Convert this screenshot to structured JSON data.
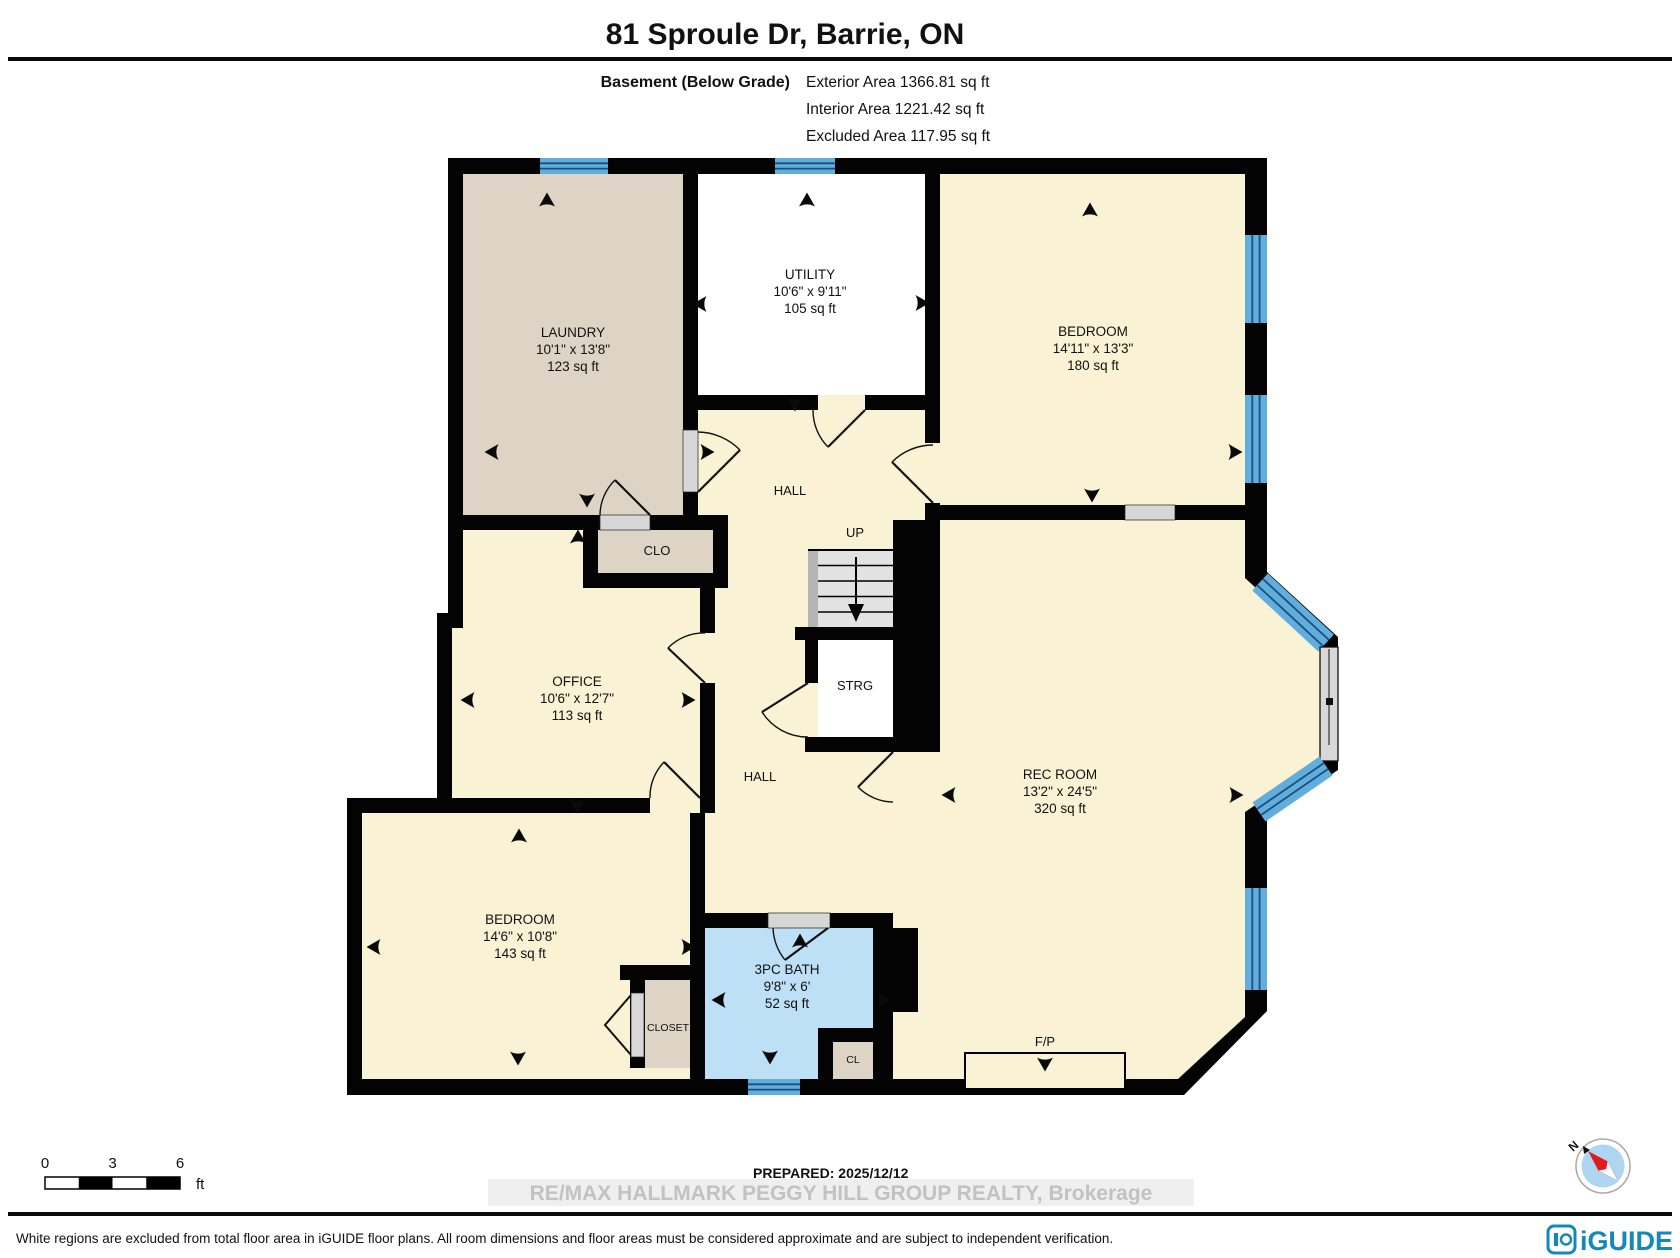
{
  "title": "81 Sproule Dr, Barrie, ON",
  "header": {
    "floor_label": "Basement (Below Grade)",
    "stats": [
      {
        "text": "Exterior Area 1366.81 sq ft"
      },
      {
        "text": "Interior Area 1221.42 sq ft"
      },
      {
        "text": "Excluded Area 117.95 sq ft"
      }
    ]
  },
  "rooms": [
    {
      "name": "LAUNDRY",
      "dims": "10'1\" x 13'8\"",
      "area": "123 sq ft"
    },
    {
      "name": "UTILITY",
      "dims": "10'6\" x 9'11\"",
      "area": "105 sq ft"
    },
    {
      "name": "BEDROOM",
      "dims": "14'11\" x 13'3\"",
      "area": "180 sq ft"
    },
    {
      "name": "OFFICE",
      "dims": "10'6\" x 12'7\"",
      "area": "113 sq ft"
    },
    {
      "name": "BEDROOM",
      "dims": "14'6\" x 10'8\"",
      "area": "143 sq ft"
    },
    {
      "name": "3PC BATH",
      "dims": "9'8\" x 6'",
      "area": "52 sq ft"
    },
    {
      "name": "REC ROOM",
      "dims": "13'2\" x 24'5\"",
      "area": "320 sq ft"
    }
  ],
  "labels": {
    "hall_upper": "HALL",
    "up": "UP",
    "clo": "CLO",
    "strg": "STRG",
    "hall_lower": "HALL",
    "closet": "CLOSET",
    "cl": "CL",
    "fireplace": "F/P"
  },
  "scale_bar": {
    "tick0": "0",
    "tick1": "3",
    "tick2": "6",
    "unit": "ft"
  },
  "compass": {
    "north": "N"
  },
  "footer": {
    "prepared": "PREPARED: 2025/12/12",
    "watermark": "RE/MAX HALLMARK PEGGY HILL GROUP REALTY, Brokerage",
    "disclaimer": "White regions are excluded from total floor area in iGUIDE floor plans. All room dimensions and floor areas must be considered approximate and are subject to independent verification.",
    "brand": "iGUIDE"
  },
  "colors": {
    "wall": "#030303",
    "room_cream": "#FAF2D5",
    "room_tan": "#DED4C6",
    "room_excluded": "#FFFFFF",
    "bath_blue": "#BEE0F6",
    "window_blue": "#5FAEDE",
    "window_stripe": "#1D4F79",
    "stair_gray": "#E2E2E2",
    "brand_blue": "#1588BB"
  }
}
